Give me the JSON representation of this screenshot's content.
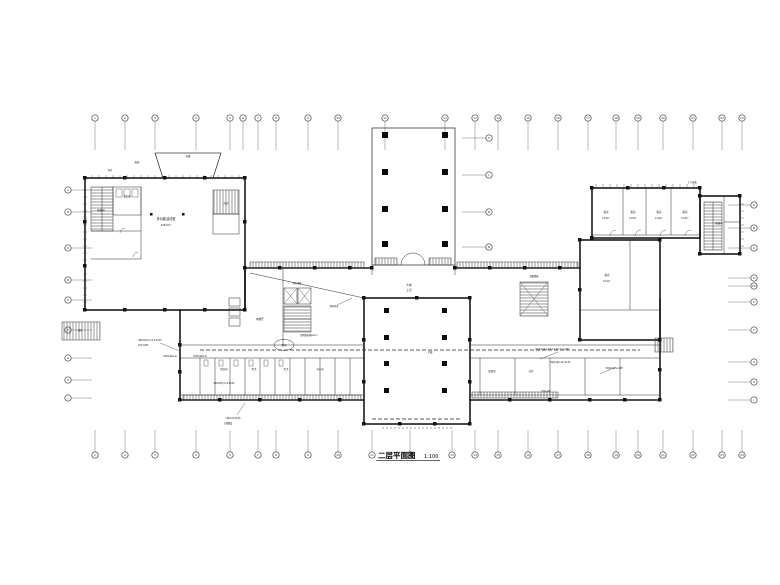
{
  "drawing": {
    "title": "二层平面图",
    "scale": "1:100"
  },
  "colors": {
    "line": "#1a1a1a",
    "grid_line": "#777777",
    "background": "#ffffff"
  },
  "grid": {
    "top": {
      "y": 118,
      "tick": 150,
      "xs": [
        95,
        125,
        155,
        196,
        230,
        243,
        258,
        276,
        308,
        338,
        385,
        445,
        475,
        498,
        528,
        558,
        588,
        616,
        638,
        663,
        693,
        722,
        742
      ],
      "labels": [
        "1",
        "2",
        "3",
        "4",
        "5",
        "6",
        "7",
        "8",
        "9",
        "10",
        "11",
        "12",
        "13",
        "14",
        "15",
        "16",
        "17",
        "18",
        "19",
        "20",
        "21",
        "22",
        "23"
      ]
    },
    "bottom": {
      "y": 455,
      "tick": 430,
      "xs": [
        95,
        125,
        155,
        196,
        230,
        258,
        276,
        308,
        338,
        372,
        410,
        452,
        475,
        498,
        528,
        558,
        588,
        616,
        638,
        663,
        693,
        722,
        742
      ],
      "labels": [
        "1",
        "2",
        "3",
        "4",
        "5",
        "7",
        "8",
        "9",
        "10",
        "11",
        "12",
        "13",
        "14",
        "15",
        "16",
        "17",
        "18",
        "19",
        "20",
        "21",
        "22",
        "23",
        "24"
      ]
    },
    "left": {
      "x": 68,
      "tick": 92,
      "ys": [
        190,
        212,
        248,
        280,
        300,
        330,
        358,
        380,
        398
      ],
      "labels": [
        "A",
        "B",
        "C",
        "D",
        "E",
        "F",
        "G",
        "H",
        "J"
      ]
    },
    "right": {
      "x": 754,
      "tick": 728,
      "ys": [
        205,
        228,
        248,
        278,
        286,
        302,
        330,
        362,
        382,
        400
      ],
      "labels": [
        "A",
        "B",
        "C",
        "D",
        "1/D",
        "E",
        "F",
        "G",
        "H",
        "J"
      ]
    },
    "atrium_right": {
      "x": 489,
      "tick": 462,
      "ys": [
        138,
        175,
        212,
        247
      ],
      "labels": [
        "K",
        "L",
        "M",
        "N"
      ]
    }
  },
  "rooms": [
    {
      "t": "多功能活动室",
      "x": 166,
      "y": 220,
      "s": 3.2
    },
    {
      "t": "128.6m²",
      "x": 166,
      "y": 226,
      "s": 2.6
    },
    {
      "t": "楼梯间",
      "x": 101,
      "y": 211,
      "s": 2.4
    },
    {
      "t": "卫生间",
      "x": 127,
      "y": 197,
      "s": 2.4
    },
    {
      "t": "库房",
      "x": 226,
      "y": 204,
      "s": 2.4
    },
    {
      "t": "客房",
      "x": 606,
      "y": 213,
      "s": 2.6
    },
    {
      "t": "12.8m²",
      "x": 606,
      "y": 219,
      "s": 2.2
    },
    {
      "t": "客房",
      "x": 633,
      "y": 213,
      "s": 2.6
    },
    {
      "t": "12.8m²",
      "x": 633,
      "y": 219,
      "s": 2.2
    },
    {
      "t": "客房",
      "x": 659,
      "y": 213,
      "s": 2.6
    },
    {
      "t": "12.8m²",
      "x": 659,
      "y": 219,
      "s": 2.2
    },
    {
      "t": "客房",
      "x": 685,
      "y": 213,
      "s": 2.6
    },
    {
      "t": "12.8m²",
      "x": 685,
      "y": 219,
      "s": 2.2
    },
    {
      "t": "客房",
      "x": 607,
      "y": 276,
      "s": 2.6
    },
    {
      "t": "32.6m²",
      "x": 607,
      "y": 282,
      "s": 2.2
    },
    {
      "t": "楼梯间",
      "x": 719,
      "y": 224,
      "s": 2.4
    },
    {
      "t": "大堂",
      "x": 409,
      "y": 286,
      "s": 2.8
    },
    {
      "t": "上空",
      "x": 409,
      "y": 291,
      "s": 2.8
    },
    {
      "t": "电梯厅",
      "x": 260,
      "y": 320,
      "s": 2.6
    },
    {
      "t": "消防电梯",
      "x": 297,
      "y": 284,
      "s": 2.2
    },
    {
      "t": "盥洗间",
      "x": 224,
      "y": 370,
      "s": 2.4
    },
    {
      "t": "男卫",
      "x": 254,
      "y": 370,
      "s": 2.4
    },
    {
      "t": "女卫",
      "x": 286,
      "y": 370,
      "s": 2.4
    },
    {
      "t": "开水间",
      "x": 320,
      "y": 370,
      "s": 2.4
    },
    {
      "t": "值班室",
      "x": 492,
      "y": 372,
      "s": 2.4
    },
    {
      "t": "库房",
      "x": 531,
      "y": 372,
      "s": 2.4
    },
    {
      "t": "走廊",
      "x": 430,
      "y": 353,
      "s": 2.4
    },
    {
      "t": "配电",
      "x": 284,
      "y": 346,
      "s": 2.4
    },
    {
      "t": "疏散楼梯",
      "x": 534,
      "y": 277,
      "s": 2.2
    },
    {
      "t": "上人屋面",
      "x": 692,
      "y": 183,
      "s": 2.4
    },
    {
      "t": "雨篷",
      "x": 188,
      "y": 157,
      "s": 2.4
    },
    {
      "t": "屋面",
      "x": 137,
      "y": 163,
      "s": 2.4
    },
    {
      "t": "坡道",
      "x": 80,
      "y": 331,
      "s": 2.2
    },
    {
      "t": "风井",
      "x": 110,
      "y": 171,
      "s": 2.2
    }
  ],
  "notes": [
    {
      "t": "WDZ-BYJ-3×2.5-SC15",
      "x": 150,
      "y": 341,
      "s": 2.2
    },
    {
      "t": "SC15-WE",
      "x": 143,
      "y": 346,
      "s": 2.2
    },
    {
      "t": "YDZ4(1φb-a)",
      "x": 170,
      "y": 357,
      "s": 2.2
    },
    {
      "t": "YDZ4(1φb-b)",
      "x": 200,
      "y": 357,
      "s": 2.2
    },
    {
      "t": "WDZ-BYJ-5×4-SC25",
      "x": 224,
      "y": 384,
      "s": 2.2
    },
    {
      "t": "YDJ4-a5-SC25",
      "x": 233,
      "y": 419,
      "s": 2.2
    },
    {
      "t": "沿墙敷设",
      "x": 228,
      "y": 424,
      "s": 2.2
    },
    {
      "t": "YDJ4(1φ6-a4)7.0-9.0(1.5-1)-WE",
      "x": 552,
      "y": 350,
      "s": 2.2
    },
    {
      "t": "YDJ4(1φ6-a5)-SC25",
      "x": 560,
      "y": 363,
      "s": 2.2
    },
    {
      "t": "YDJ4(1φb-a)-WE",
      "x": 614,
      "y": 369,
      "s": 2.2
    },
    {
      "t": "照明配电箱AL2-1",
      "x": 309,
      "y": 336,
      "s": 2.2
    },
    {
      "t": "消防卷帘",
      "x": 334,
      "y": 307,
      "s": 2.2
    },
    {
      "t": "YDJ4-WE",
      "x": 546,
      "y": 392,
      "s": 2.2
    }
  ]
}
